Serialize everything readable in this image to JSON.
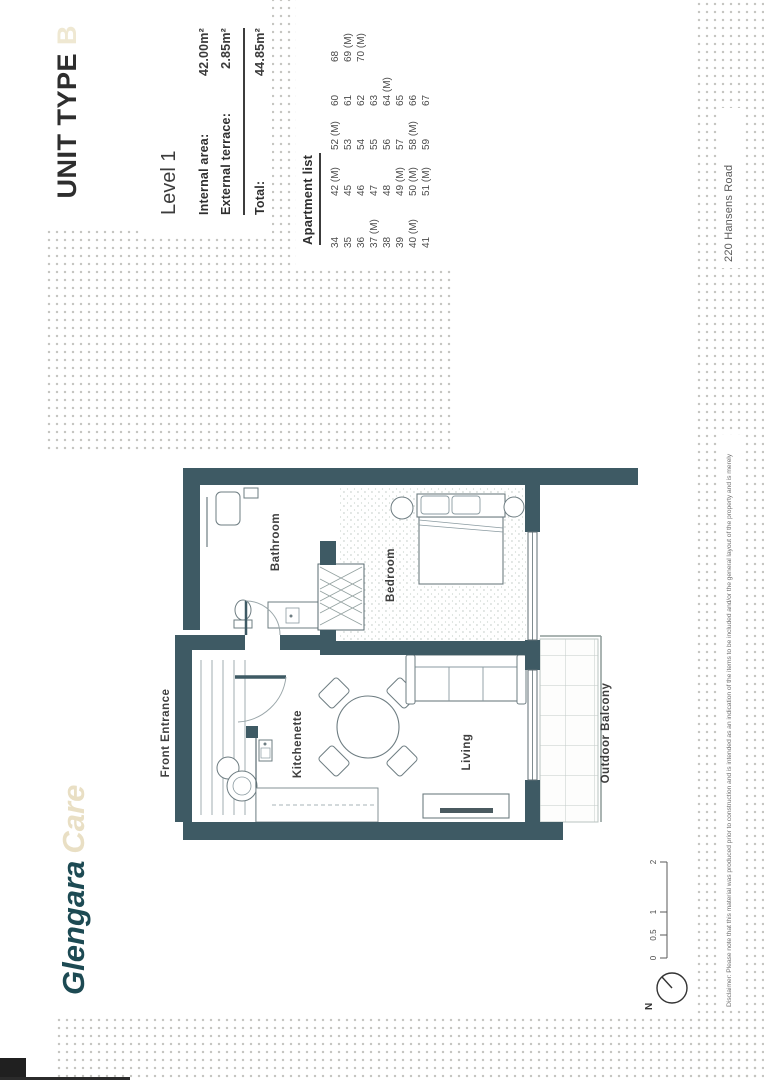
{
  "branding": {
    "logo_primary": "Glengara",
    "logo_secondary": "Care",
    "logo_primary_color": "#1d4a53",
    "logo_secondary_color": "#e9dfc4"
  },
  "header": {
    "title": "UNIT TYPE",
    "title_suffix": "B"
  },
  "info_panel": {
    "level": "Level 1",
    "rows": [
      {
        "label": "Internal area:",
        "value": "42.00m²"
      },
      {
        "label": "External terrace:",
        "value": "2.85m²"
      }
    ],
    "total_label": "Total:",
    "total_value": "44.85m²"
  },
  "apartment_list": {
    "title": "Apartment list",
    "columns": [
      [
        "34",
        "35",
        "36",
        "37 (M)",
        "38",
        "39",
        "40 (M)",
        "41"
      ],
      [
        "42 (M)",
        "45",
        "46",
        "47",
        "48",
        "49 (M)",
        "50 (M)",
        "51 (M)"
      ],
      [
        "52 (M)",
        "53",
        "54",
        "55",
        "56",
        "57",
        "58 (M)",
        "59"
      ],
      [
        "60",
        "61",
        "62",
        "63",
        "64 (M)",
        "65",
        "66",
        "67"
      ],
      [
        "68",
        "69 (M)",
        "70 (M)"
      ]
    ]
  },
  "floor_plan": {
    "labels": {
      "front_entrance": "Front Entrance",
      "bathroom": "Bathroom",
      "bedroom": "Bedroom",
      "kitchenette": "Kitchenette",
      "living": "Living",
      "outdoor_balcony": "Outdoor Balcony"
    }
  },
  "scale_bar": {
    "ticks": [
      "0",
      "0.5",
      "1",
      "2"
    ]
  },
  "compass": {
    "label": "N"
  },
  "footer": {
    "disclaimer": "Disclaimer: Please note that this material was produced prior to construction and is intended as an indication of the items to be included and/or the general layout of the property and is merely",
    "address": "220 Hansens Road"
  },
  "colors": {
    "wall": "#3e5a64",
    "dots": "#c4c4bf"
  }
}
